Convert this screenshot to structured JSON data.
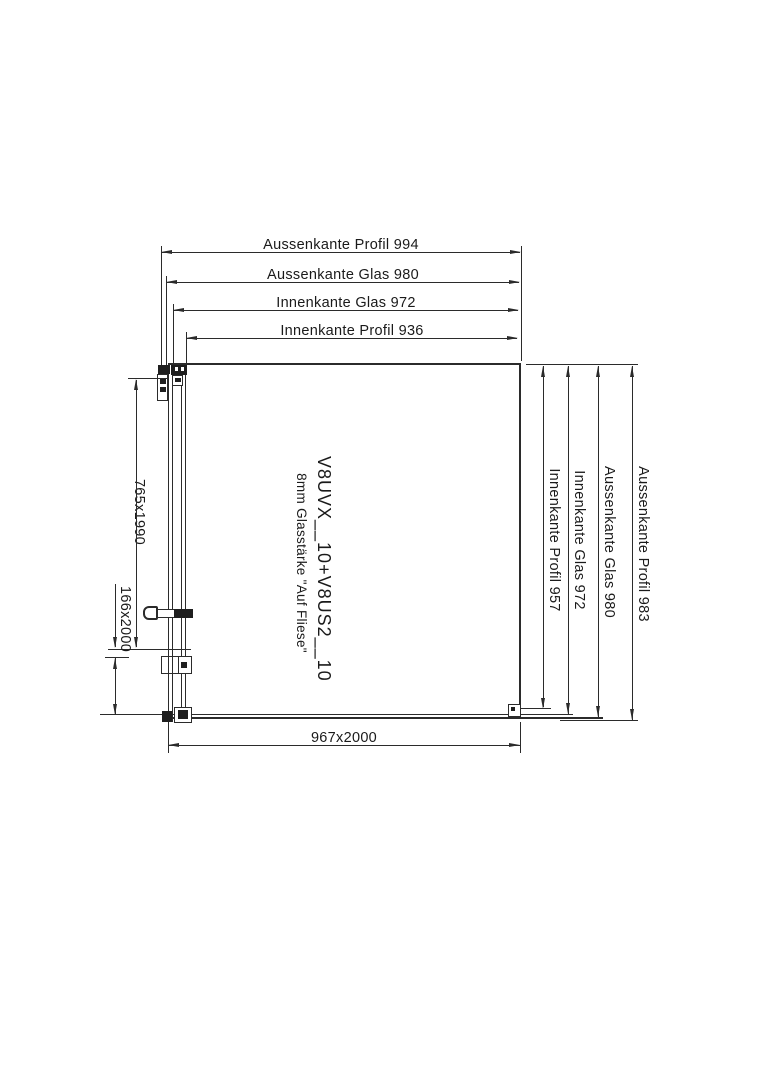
{
  "drawing": {
    "title": "Shower enclosure dimension drawing",
    "top_dimensions": [
      {
        "label": "Aussenkante Profil 994"
      },
      {
        "label": "Aussenkante Glas 980"
      },
      {
        "label": "Innenkante Glas 972"
      },
      {
        "label": "Innenkante Profil 936"
      }
    ],
    "right_dimensions": [
      {
        "label": "Innenkante Profil 957"
      },
      {
        "label": "Innenkante Glas 972"
      },
      {
        "label": "Aussenkante Glas 980"
      },
      {
        "label": "Aussenkante Profil 983"
      }
    ],
    "left_dimensions": [
      {
        "label": "765x1990"
      },
      {
        "label": "166x2000"
      }
    ],
    "bottom_dimension": {
      "label": "967x2000"
    },
    "center_labels": {
      "model": "V8UVX__10+V8US2__10",
      "glass": "8mm Glasstärke \"Auf Fliese\""
    },
    "colors": {
      "line": "#2b2b2b",
      "text": "#1a1a1a",
      "background": "#ffffff"
    }
  }
}
